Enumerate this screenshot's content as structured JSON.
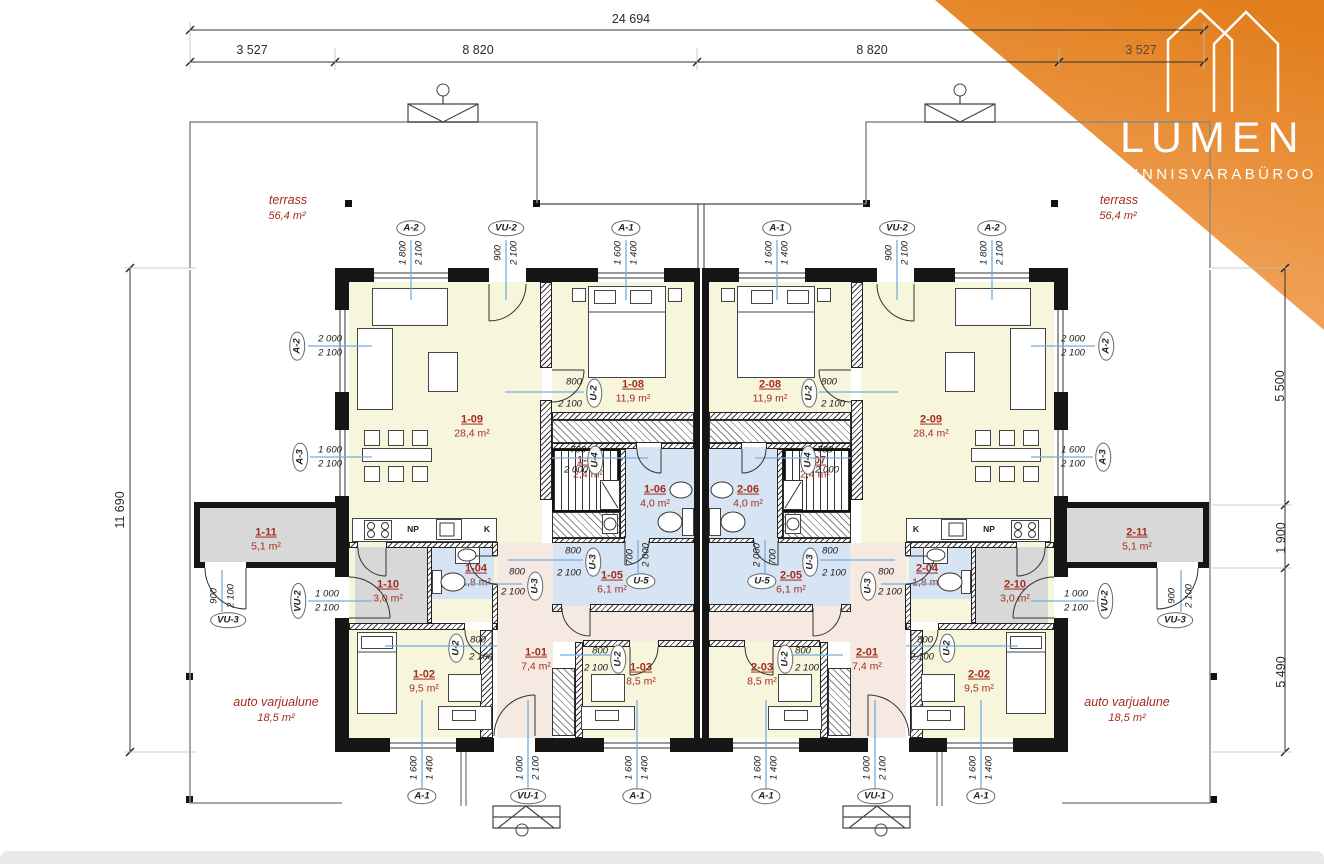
{
  "logo": {
    "brand": "LUMEN",
    "subtitle": "KINNISVARABÜROO"
  },
  "colors": {
    "accent_orange": "#e8821e",
    "label_red": "#a42d1e",
    "leader_blue": "#74aede",
    "fill_cream": "#f8f5dd",
    "fill_blue": "#d7e4f3",
    "fill_pink": "#f6e9e2",
    "fill_gray": "#d8d8d8"
  },
  "dims": {
    "total_width": "24 694",
    "seg1": "3 527",
    "seg2": "8 820",
    "seg3": "8 820",
    "seg4": "3 527",
    "left_height": "11 690",
    "right1": "5 500",
    "right2": "1 900",
    "right3": "5 490"
  },
  "outdoor": {
    "terrace_l_name": "terrass",
    "terrace_l_area": "56,4 m²",
    "terrace_r_name": "terrass",
    "terrace_r_area": "56,4 m²",
    "carport_l_name": "auto varjualune",
    "carport_l_area": "18,5 m²",
    "carport_r_name": "auto varjualune",
    "carport_r_area": "18,5 m²"
  },
  "kitchen": {
    "np": "NP",
    "k": "K"
  },
  "rooms": {
    "r101": {
      "id": "1-01",
      "area": "7,4 m²"
    },
    "r102": {
      "id": "1-02",
      "area": "9,5 m²"
    },
    "r103": {
      "id": "1-03",
      "area": "8,5 m²"
    },
    "r104": {
      "id": "1-04",
      "area": "1,8 m²"
    },
    "r105": {
      "id": "1-05",
      "area": "6,1 m²"
    },
    "r106": {
      "id": "1-06",
      "area": "4,0 m²"
    },
    "r107": {
      "id": "1-07",
      "area": "2,4 m²"
    },
    "r108": {
      "id": "1-08",
      "area": "11,9 m²"
    },
    "r109": {
      "id": "1-09",
      "area": "28,4 m²"
    },
    "r110": {
      "id": "1-10",
      "area": "3,0 m²"
    },
    "r111": {
      "id": "1-11",
      "area": "5,1 m²"
    },
    "r201": {
      "id": "2-01",
      "area": "7,4 m²"
    },
    "r202": {
      "id": "2-02",
      "area": "9,5 m²"
    },
    "r203": {
      "id": "2-03",
      "area": "8,5 m²"
    },
    "r204": {
      "id": "2-04",
      "area": "1,8 m²"
    },
    "r205": {
      "id": "2-05",
      "area": "6,1 m²"
    },
    "r206": {
      "id": "2-06",
      "area": "4,0 m²"
    },
    "r207": {
      "id": "2-07",
      "area": "2,4 m²"
    },
    "r208": {
      "id": "2-08",
      "area": "11,9 m²"
    },
    "r209": {
      "id": "2-09",
      "area": "28,4 m²"
    },
    "r210": {
      "id": "2-10",
      "area": "3,0 m²"
    },
    "r211": {
      "id": "2-11",
      "area": "5,1 m²"
    }
  },
  "openings": [
    {
      "label": "A-2",
      "d1": "1 800",
      "d2": "2 100"
    },
    {
      "label": "VU-2",
      "d1": "900",
      "d2": "2 100"
    },
    {
      "label": "A-1",
      "d1": "1 600",
      "d2": "1 400"
    },
    {
      "label": "A-1",
      "d1": "1 600",
      "d2": "1 400"
    },
    {
      "label": "VU-2",
      "d1": "900",
      "d2": "2 100"
    },
    {
      "label": "A-2",
      "d1": "1 800",
      "d2": "2 100"
    },
    {
      "label": "A-2",
      "d1": "2 000",
      "d2": "2 100"
    },
    {
      "label": "A-3",
      "d1": "1 600",
      "d2": "2 100"
    },
    {
      "label": "VU-2",
      "d1": "1 000",
      "d2": "2 100"
    },
    {
      "label": "VU-3",
      "d1": "900",
      "d2": "2 100"
    },
    {
      "label": "A-2",
      "d1": "2 000",
      "d2": "2 100"
    },
    {
      "label": "A-3",
      "d1": "1 600",
      "d2": "2 100"
    },
    {
      "label": "VU-2",
      "d1": "1 000",
      "d2": "2 100"
    },
    {
      "label": "VU-3",
      "d1": "900",
      "d2": "2 100"
    },
    {
      "label": "A-1",
      "d1": "1 600",
      "d2": "1 400"
    },
    {
      "label": "VU-1",
      "d1": "1 000",
      "d2": "2 100"
    },
    {
      "label": "A-1",
      "d1": "1 600",
      "d2": "1 400"
    },
    {
      "label": "A-1",
      "d1": "1 600",
      "d2": "1 400"
    },
    {
      "label": "VU-1",
      "d1": "1 000",
      "d2": "2 100"
    },
    {
      "label": "A-1",
      "d1": "1 600",
      "d2": "1 400"
    },
    {
      "label": "U-2",
      "d1": "800",
      "d2": "2 100"
    },
    {
      "label": "U-4",
      "d1": "700",
      "d2": "2 000"
    },
    {
      "label": "U-5",
      "d1": "700",
      "d2": "2 000"
    },
    {
      "label": "U-3",
      "d1": "800",
      "d2": "2 100"
    },
    {
      "label": "U-3",
      "d1": "800",
      "d2": "2 100"
    },
    {
      "label": "U-2",
      "d1": "800",
      "d2": "2 100"
    },
    {
      "label": "U-2",
      "d1": "800",
      "d2": "2 100"
    },
    {
      "label": "U-2",
      "d1": "800",
      "d2": "2 100"
    },
    {
      "label": "U-4",
      "d1": "700",
      "d2": "2 000"
    },
    {
      "label": "U-5",
      "d1": "700",
      "d2": "2 000"
    },
    {
      "label": "U-3",
      "d1": "800",
      "d2": "2 100"
    },
    {
      "label": "U-3",
      "d1": "800",
      "d2": "2 100"
    },
    {
      "label": "U-2",
      "d1": "800",
      "d2": "2 100"
    },
    {
      "label": "U-2",
      "d1": "800",
      "d2": "2 100"
    }
  ]
}
